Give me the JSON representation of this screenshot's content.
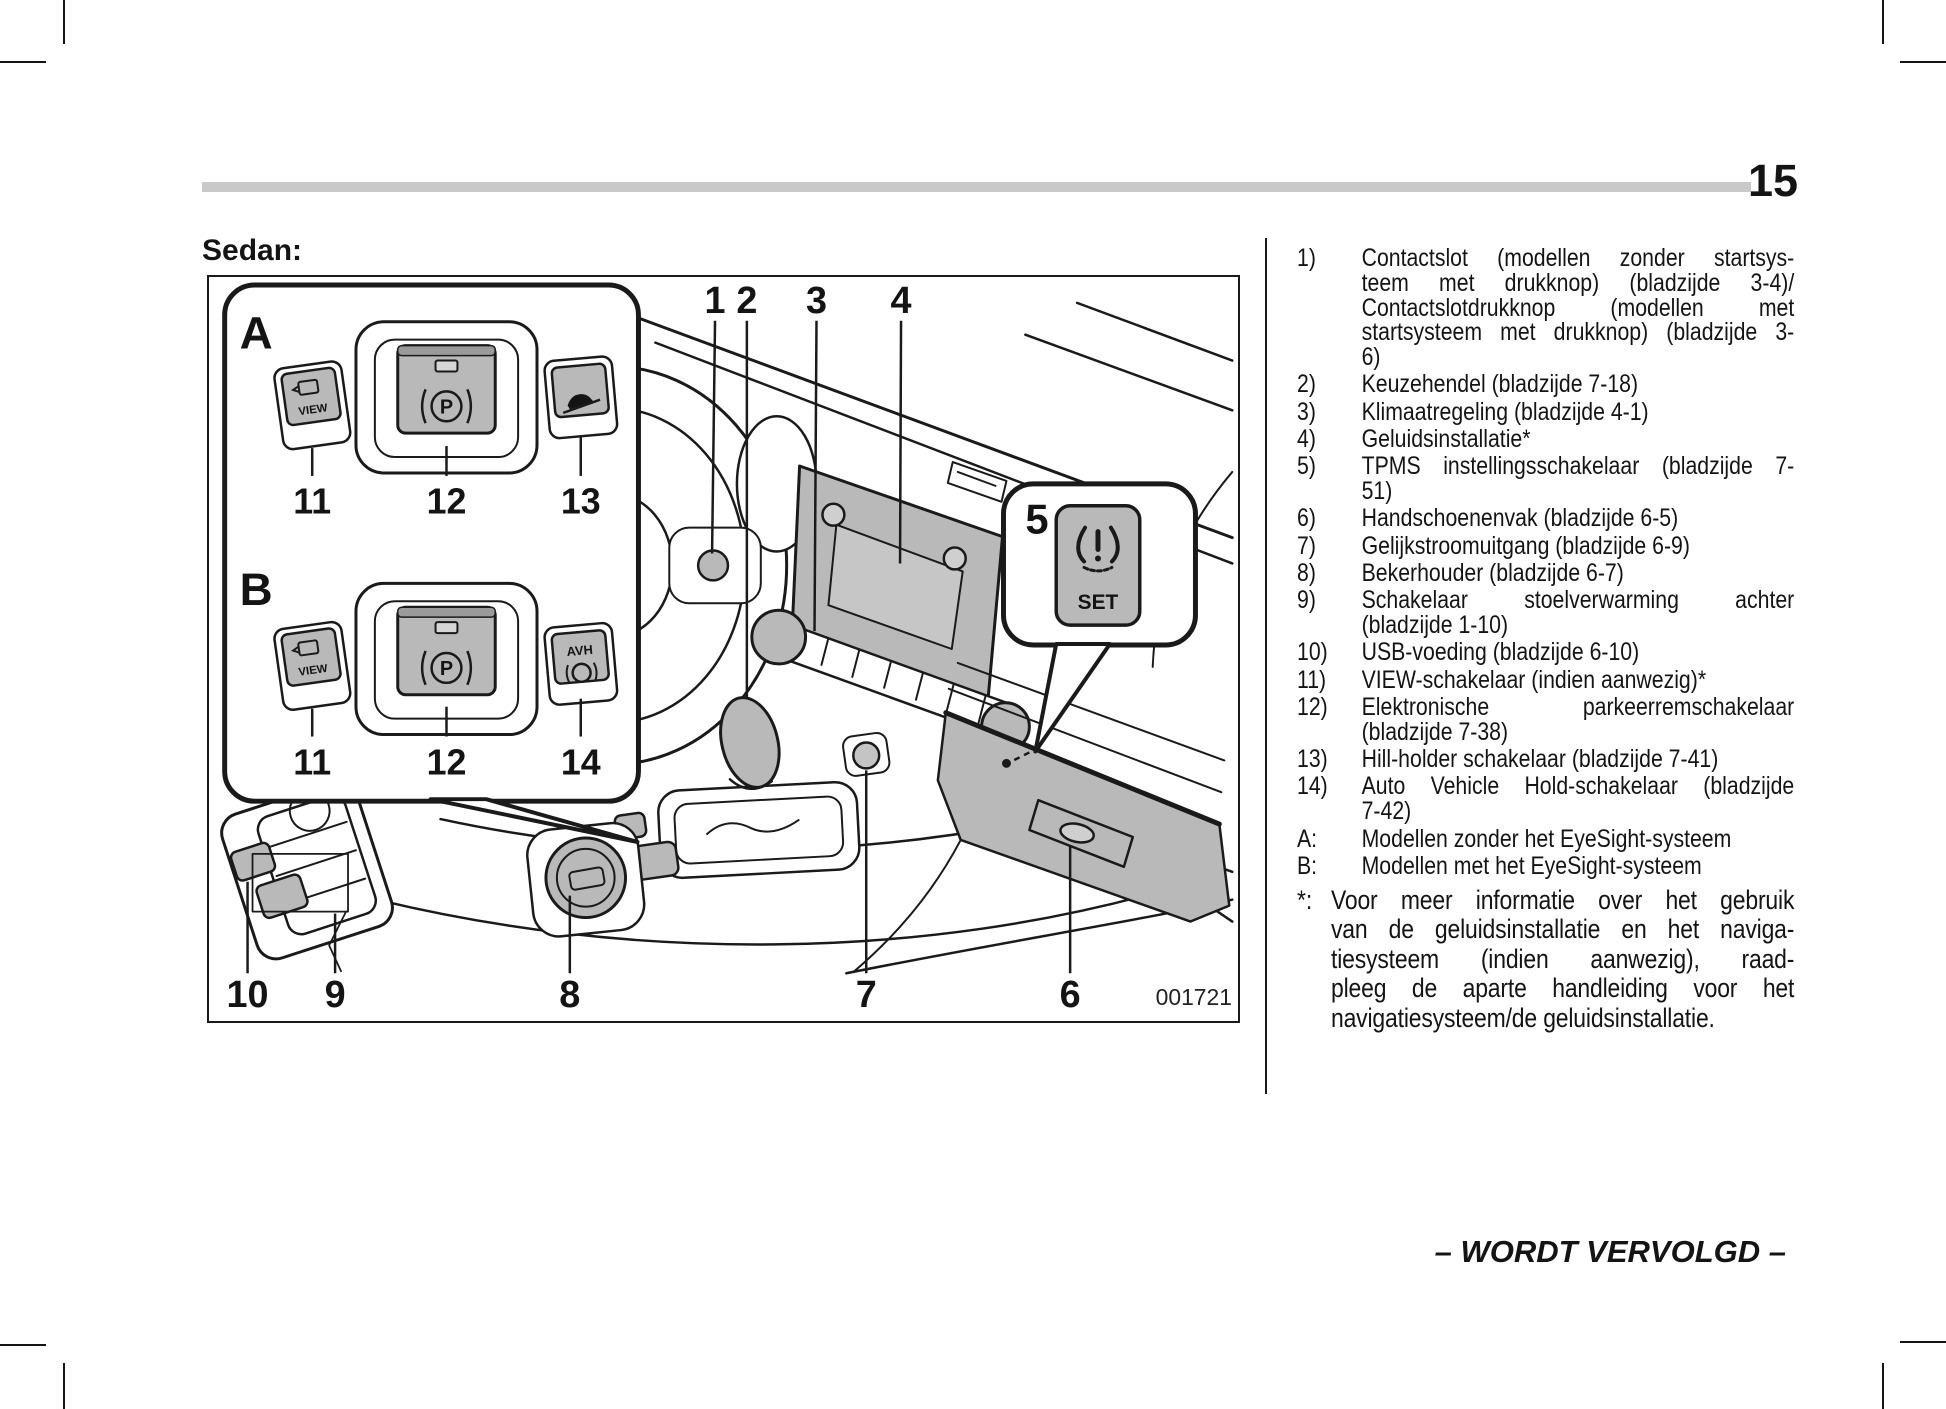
{
  "page": {
    "number": "15"
  },
  "sedan_label": "Sedan:",
  "figure": {
    "id": "001721",
    "inset": {
      "section_a": "A",
      "section_b": "B",
      "view_label": "VIEW",
      "p_label": "P",
      "avh_label": "AVH",
      "row_a_numbers": [
        "11",
        "12",
        "13"
      ],
      "row_b_numbers": [
        "11",
        "12",
        "14"
      ]
    },
    "balloon": {
      "number": "5",
      "set_label": "SET"
    },
    "top_callouts": [
      "1",
      "2",
      "3",
      "4"
    ],
    "bottom_callouts": [
      "10",
      "9",
      "8",
      "7",
      "6"
    ]
  },
  "legend": {
    "items": [
      {
        "marker": "1)",
        "lines": [
          "Contactslot (modellen zonder startsys-",
          "teem met drukknop) (bladzijde 3-4)/",
          "Contactslotdrukknop (modellen met",
          "startsysteem met drukknop) (bladzijde 3-",
          "6)"
        ]
      },
      {
        "marker": "2)",
        "lines": [
          "Keuzehendel (bladzijde 7-18)"
        ]
      },
      {
        "marker": "3)",
        "lines": [
          "Klimaatregeling (bladzijde 4-1)"
        ]
      },
      {
        "marker": "4)",
        "lines": [
          "Geluidsinstallatie*"
        ]
      },
      {
        "marker": "5)",
        "lines": [
          "TPMS instellingsschakelaar (bladzijde 7-",
          "51)"
        ]
      },
      {
        "marker": "6)",
        "lines": [
          "Handschoenenvak (bladzijde 6-5)"
        ]
      },
      {
        "marker": "7)",
        "lines": [
          "Gelijkstroomuitgang (bladzijde 6-9)"
        ]
      },
      {
        "marker": "8)",
        "lines": [
          "Bekerhouder (bladzijde 6-7)"
        ]
      },
      {
        "marker": "9)",
        "lines": [
          "Schakelaar stoelverwarming achter",
          "(bladzijde 1-10)"
        ]
      },
      {
        "marker": "10)",
        "lines": [
          "USB-voeding (bladzijde 6-10)"
        ]
      },
      {
        "marker": "11)",
        "lines": [
          "VIEW-schakelaar (indien aanwezig)*"
        ]
      },
      {
        "marker": "12)",
        "lines": [
          "Elektronische parkeerremschakelaar",
          "(bladzijde 7-38)"
        ]
      },
      {
        "marker": "13)",
        "lines": [
          "Hill-holder schakelaar (bladzijde 7-41)"
        ]
      },
      {
        "marker": "14)",
        "lines": [
          "Auto Vehicle Hold-schakelaar (bladzijde",
          "7-42)"
        ]
      },
      {
        "marker": "A:",
        "lines": [
          "Modellen zonder het EyeSight-systeem"
        ]
      },
      {
        "marker": "B:",
        "lines": [
          "Modellen met het EyeSight-systeem"
        ]
      }
    ]
  },
  "note": {
    "marker": "*:",
    "lines": [
      "Voor meer informatie over het gebruik",
      "van de geluidsinstallatie en het naviga-",
      "tiesysteem (indien aanwezig), raad-",
      "pleeg de aparte handleiding voor het",
      "navigatiesysteem/de geluidsinstallatie."
    ]
  },
  "footer": {
    "text": "– WORDT VERVOLGD –"
  },
  "colors": {
    "ink": "#1a1a1a",
    "button_gray": "#b9b9b9",
    "rule_gray": "#c9c9c9"
  }
}
